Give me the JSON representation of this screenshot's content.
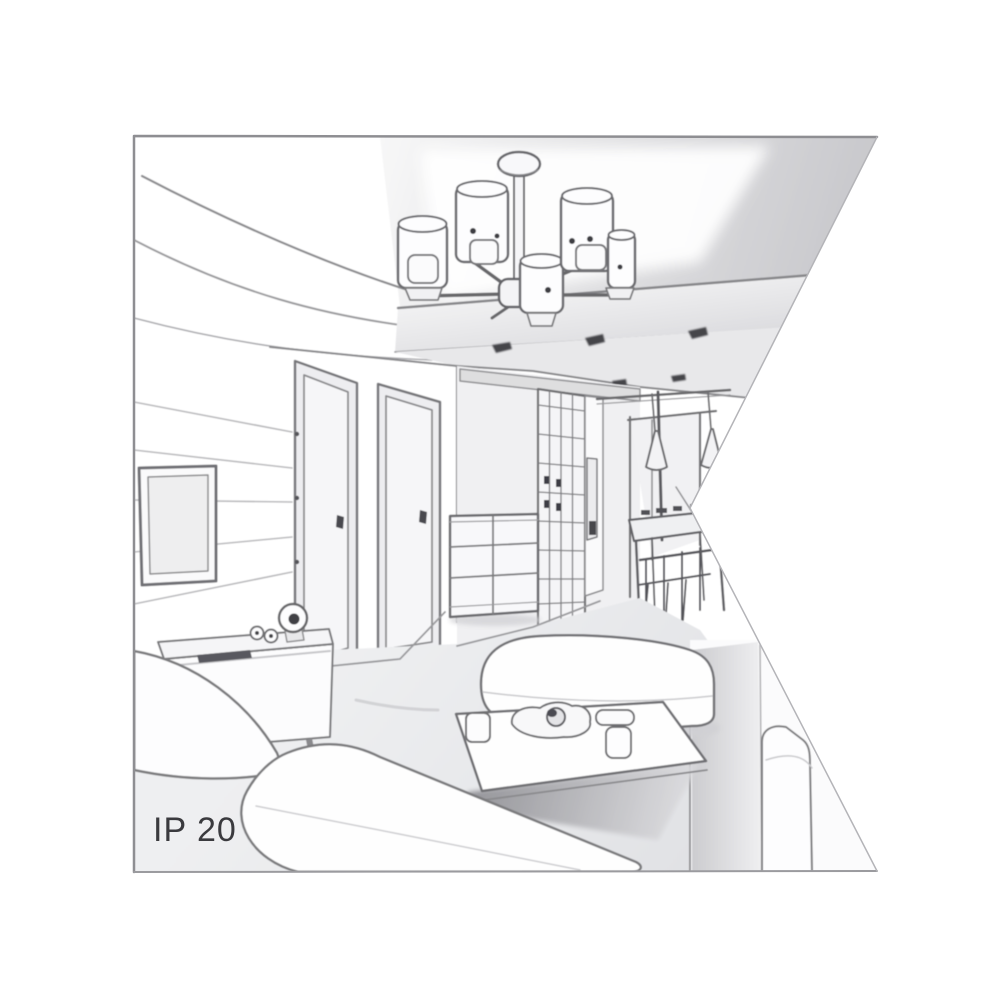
{
  "illustration": {
    "caption": "IP 20",
    "kind": "grayscale perspective line drawing of an apartment interior",
    "scene": {
      "room": "living room with hallway and dining nook",
      "objects": [
        "six-arm ceiling chandelier with cylindrical shades",
        "recessed ceiling panel with downlight spots",
        "wall-mounted tv",
        "tv sideboard with clock, speakers and remote",
        "two interior doors",
        "glass-grid wardrobe",
        "chest of drawers",
        "dining table with chairs",
        "two cone pendant lights",
        "coffee table with tray and cups",
        "corner sofa",
        "right sofa",
        "bench seat"
      ]
    },
    "colors": {
      "background": "#ffffff",
      "line": "#6a6a6e",
      "soft_line": "#9b9b9e",
      "shade_light": "#e9e9eb",
      "shade_mid": "#d2d2d6",
      "shadow_dark": "#8c8c91",
      "caption_text": "#3a3a3e",
      "border": "#9a9a9e"
    }
  }
}
